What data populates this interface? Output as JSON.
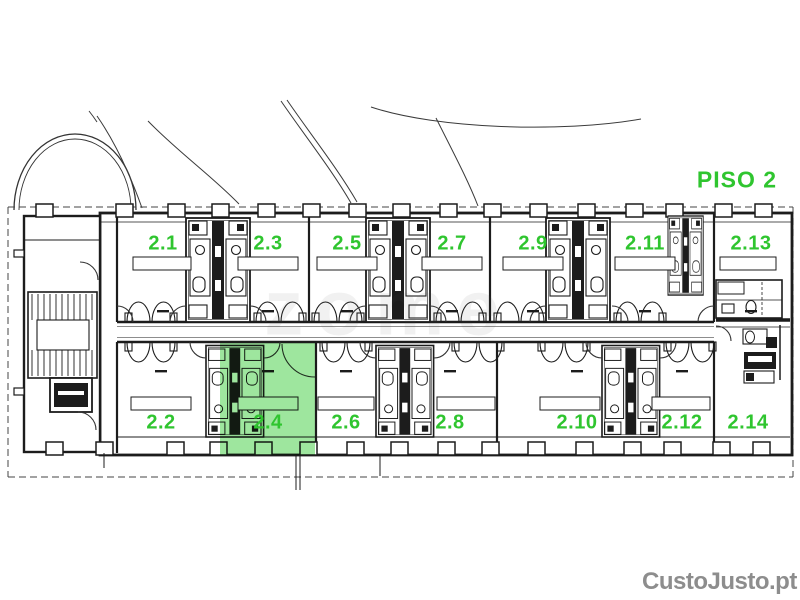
{
  "floor": {
    "label": "PISO 2"
  },
  "rooms": [
    {
      "label": "2.1",
      "row": "top",
      "x": 163,
      "y": 244,
      "highlighted": false
    },
    {
      "label": "2.3",
      "row": "top",
      "x": 268,
      "y": 244,
      "highlighted": false
    },
    {
      "label": "2.5",
      "row": "top",
      "x": 347,
      "y": 244,
      "highlighted": false
    },
    {
      "label": "2.7",
      "row": "top",
      "x": 452,
      "y": 244,
      "highlighted": false
    },
    {
      "label": "2.9",
      "row": "top",
      "x": 533,
      "y": 244,
      "highlighted": false
    },
    {
      "label": "2.11",
      "row": "top",
      "x": 645,
      "y": 244,
      "highlighted": false
    },
    {
      "label": "2.13",
      "row": "top",
      "x": 751,
      "y": 244,
      "highlighted": false
    },
    {
      "label": "2.2",
      "row": "bottom",
      "x": 161,
      "y": 423,
      "highlighted": false
    },
    {
      "label": "2.4",
      "row": "bottom",
      "x": 268,
      "y": 423,
      "highlighted": true
    },
    {
      "label": "2.6",
      "row": "bottom",
      "x": 346,
      "y": 423,
      "highlighted": false
    },
    {
      "label": "2.8",
      "row": "bottom",
      "x": 450,
      "y": 423,
      "highlighted": false
    },
    {
      "label": "2.10",
      "row": "bottom",
      "x": 577,
      "y": 423,
      "highlighted": false
    },
    {
      "label": "2.12",
      "row": "bottom",
      "x": 682,
      "y": 423,
      "highlighted": false
    },
    {
      "label": "2.14",
      "row": "bottom",
      "x": 748,
      "y": 423,
      "highlighted": false
    }
  ],
  "highlight": {
    "room": "2.4",
    "x": 220,
    "y": 343,
    "width": 95,
    "height": 112
  },
  "watermarks": {
    "center": "zome",
    "bottom_right": "CustoJusto.pt"
  },
  "colors": {
    "label_green": "#2fc52f",
    "highlight_green": "rgba(62,205,62,0.5)",
    "watermark_gray": "#8d8d8d",
    "line": "#1c1c1c"
  }
}
